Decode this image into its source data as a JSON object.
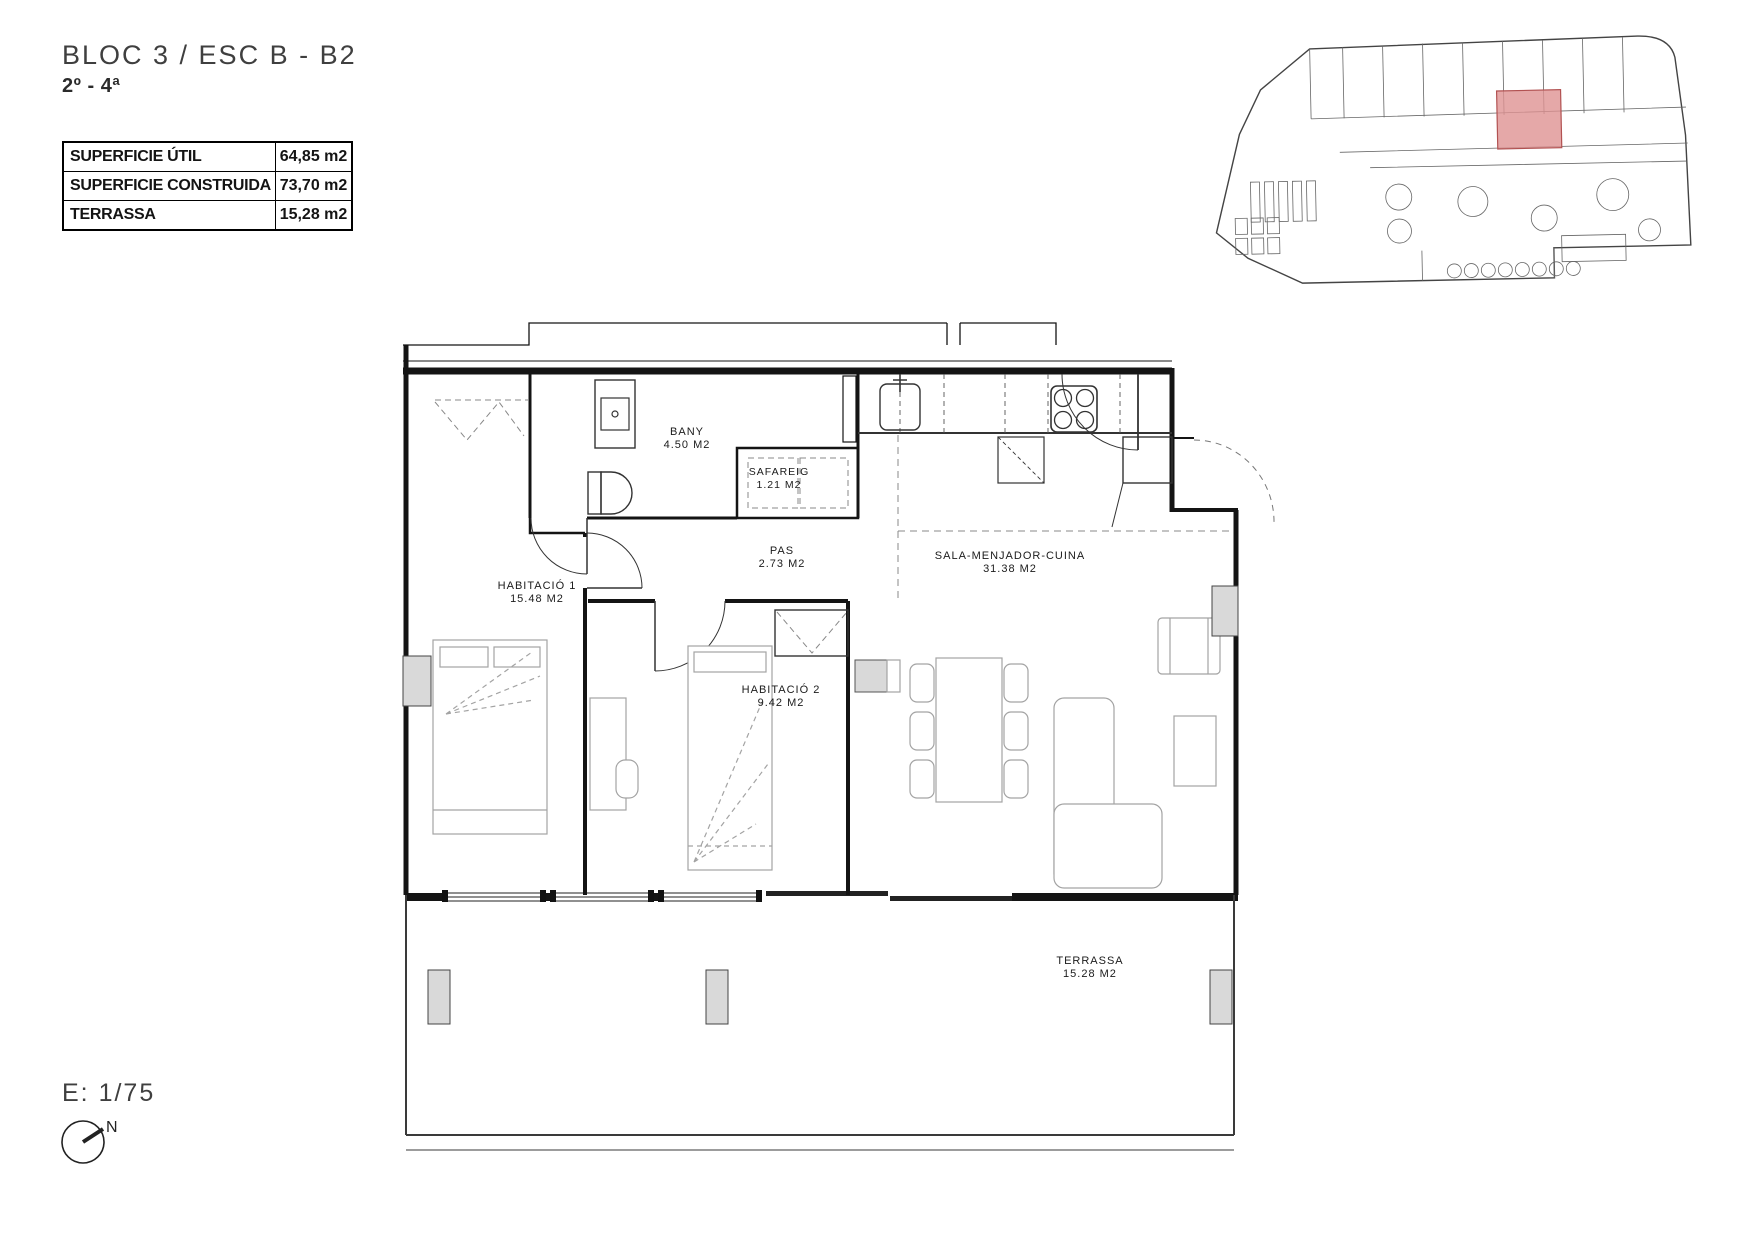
{
  "header": {
    "title": "BLOC 3 / ESC B - B2",
    "subtitle": "2º - 4ª"
  },
  "summary_table": {
    "rows": [
      {
        "label": "SUPERFICIE ÚTIL",
        "value": "64,85 m2"
      },
      {
        "label": "SUPERFICIE CONSTRUIDA",
        "value": "73,70 m2"
      },
      {
        "label": "TERRASSA",
        "value": "15,28 m2"
      }
    ]
  },
  "floor_plan": {
    "rooms": [
      {
        "name": "BANY",
        "area": "4.50 M2"
      },
      {
        "name": "SAFAREIG",
        "area": "1.21 M2"
      },
      {
        "name": "PAS",
        "area": "2.73 M2"
      },
      {
        "name": "HABITACIÓ 1",
        "area": "15.48 M2"
      },
      {
        "name": "HABITACIÓ 2",
        "area": "9.42 M2"
      },
      {
        "name": "SALA-MENJADOR-CUINA",
        "area": "31.38 M2"
      },
      {
        "name": "TERRASSA",
        "area": "15.28 M2"
      }
    ]
  },
  "minimap": {
    "highlight_color": "#df9292"
  },
  "footer": {
    "scale": "E: 1/75",
    "north_label": "N"
  },
  "colors": {
    "wall": "#141414",
    "furniture": "#a3a3a3",
    "pillar": "#d9d9d9",
    "highlight_border": "#b25252"
  }
}
